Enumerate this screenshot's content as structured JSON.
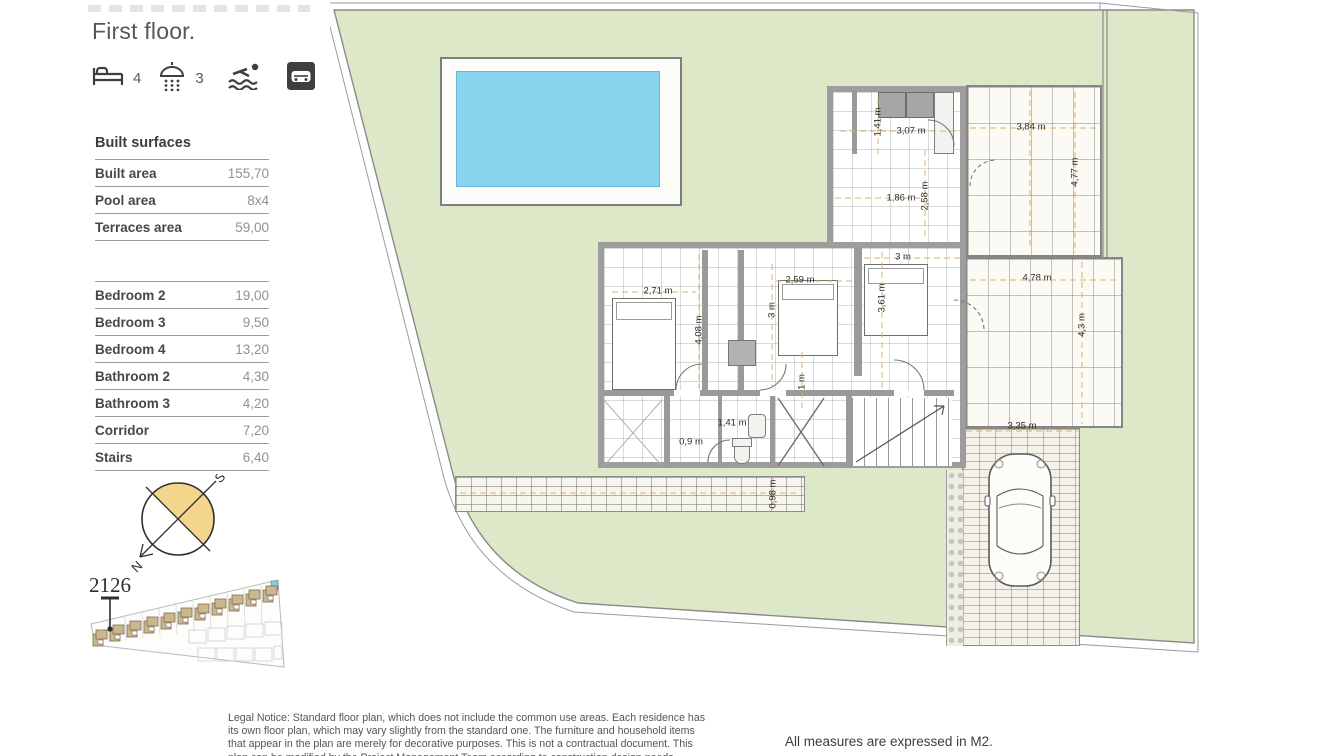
{
  "page": {
    "title": "First floor."
  },
  "features": {
    "bedrooms_count": "4",
    "bathrooms_count": "3"
  },
  "built_surfaces": {
    "heading": "Built surfaces",
    "rows": [
      {
        "label": "Built area",
        "value": "155,70"
      },
      {
        "label": "Pool area",
        "value": "8x4"
      },
      {
        "label": "Terraces area",
        "value": "59,00"
      }
    ]
  },
  "room_surfaces": {
    "rows": [
      {
        "label": "Bedroom 2",
        "value": "19,00"
      },
      {
        "label": "Bedroom 3",
        "value": "9,50"
      },
      {
        "label": "Bedroom 4",
        "value": "13,20"
      },
      {
        "label": "Bathroom 2",
        "value": "4,30"
      },
      {
        "label": "Bathroom 3",
        "value": "4,20"
      },
      {
        "label": "Corridor",
        "value": "7,20"
      },
      {
        "label": "Stairs",
        "value": "6,40"
      }
    ]
  },
  "compass": {
    "north": "N",
    "south": "S"
  },
  "site_plan": {
    "unit": "2126"
  },
  "floor_plan": {
    "dimension_labels": [
      {
        "t": "1,41 m",
        "x": 548,
        "y": 122,
        "r": -90
      },
      {
        "t": "3,07 m",
        "x": 581,
        "y": 131,
        "r": 0
      },
      {
        "t": "3,84 m",
        "x": 701,
        "y": 127,
        "r": 0
      },
      {
        "t": "4,77 m",
        "x": 745,
        "y": 172,
        "r": -90
      },
      {
        "t": "1,86 m",
        "x": 571,
        "y": 198,
        "r": 0
      },
      {
        "t": "2,58 m",
        "x": 595,
        "y": 196,
        "r": -90
      },
      {
        "t": "3 m",
        "x": 573,
        "y": 257,
        "r": 0
      },
      {
        "t": "2,59 m",
        "x": 470,
        "y": 280,
        "r": 0
      },
      {
        "t": "3 m",
        "x": 442,
        "y": 310,
        "r": -90
      },
      {
        "t": "3,61 m",
        "x": 552,
        "y": 298,
        "r": -90
      },
      {
        "t": "2,71 m",
        "x": 328,
        "y": 291,
        "r": 0
      },
      {
        "t": "4,08 m",
        "x": 369,
        "y": 330,
        "r": -90
      },
      {
        "t": "1 m",
        "x": 472,
        "y": 382,
        "r": -90
      },
      {
        "t": "4,78 m",
        "x": 707,
        "y": 278,
        "r": 0
      },
      {
        "t": "4,3 m",
        "x": 752,
        "y": 325,
        "r": -90
      },
      {
        "t": "1,41 m",
        "x": 402,
        "y": 423,
        "r": 0
      },
      {
        "t": "0,9 m",
        "x": 361,
        "y": 442,
        "r": 0
      },
      {
        "t": "3,35 m",
        "x": 692,
        "y": 426,
        "r": 0
      },
      {
        "t": "0,98 m",
        "x": 443,
        "y": 494,
        "r": -90
      }
    ]
  },
  "footer": {
    "legal_notice": "Legal Notice: Standard floor plan, which does not include the common use areas. Each residence has its own floor plan, which may vary slightly from the standard one. The furniture and household items that appear in the plan are merely for decorative purposes. This is not a contractual document. This plan can be modified by the Project Management Team according to construction design needs.",
    "measures_note": "All measures are expressed in M2."
  },
  "colors": {
    "garden_green": "#dce8c8",
    "pool_blue": "#8ad5ee",
    "wall_gray": "#9a9a9a",
    "dimension_line": "#d7ab5e",
    "compass_yellow": "#f3d68c"
  }
}
